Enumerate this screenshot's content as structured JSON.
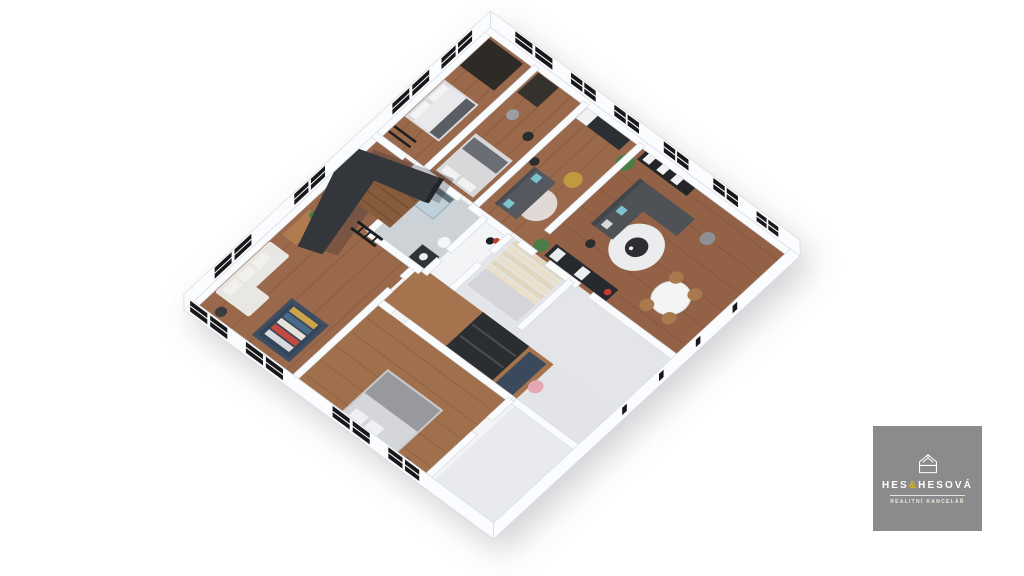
{
  "page": {
    "background_color": "#ffffff",
    "description": "3D isometric cutaway floor plan rendering of a furnished apartment storey"
  },
  "logo": {
    "brand_pre": "HES",
    "brand_amp": "&",
    "brand_post": "HESOVÁ",
    "tagline": "REALITNÍ KANCELÁŘ",
    "background_color": "#8a8b8d",
    "text_color": "#ffffff",
    "ampersand_color": "#d9b411",
    "icon": "house-outline-icon"
  },
  "floor_plan": {
    "projection": "isometric-cutaway",
    "wall_color": "#fbfcfd",
    "window_frame_color": "#17181a",
    "wood_floor_color": "#9a684a",
    "tile_floor_color": "#cdd2d7",
    "dark_accent_color": "#33373c",
    "window_count": 14,
    "door_openings_southeast": 4,
    "rooms": [
      {
        "name": "lounge-office-northwest",
        "furniture": [
          "white-corner-sofa",
          "wooden-desk",
          "desk-chair",
          "navy-open-wardrobe-with-clothes",
          "dark-side-table",
          "plant"
        ]
      },
      {
        "name": "loft-structure",
        "furniture": [
          "black-elevated-loft-volume",
          "wood-panel-wall",
          "black-ladder"
        ]
      },
      {
        "name": "bathroom-center",
        "furniture": [
          "glass-shower-cabin",
          "dark-vanity",
          "toilet"
        ]
      },
      {
        "name": "bedroom-north",
        "furniture": [
          "double-bed",
          "dark-wardrobe",
          "black-ladder"
        ]
      },
      {
        "name": "bedroom-middle",
        "furniture": [
          "double-bed",
          "floor-lamp",
          "dark-wardrobe",
          "grey-pouf"
        ]
      },
      {
        "name": "studio-kitchen-lounge",
        "furniture": [
          "grey-sofa-cyan-pillows",
          "kitchenette-counter",
          "fridge",
          "round-rug",
          "mustard-armchair",
          "floor-lamp"
        ]
      },
      {
        "name": "living-dining-southeast",
        "furniture": [
          "dark-corner-sofa",
          "round-coffee-table",
          "white-round-rug",
          "white-dining-table",
          "wooden-dining-chairs",
          "dark-kitchen-run",
          "media-shelf-unit",
          "potted-plant",
          "floor-lamp",
          "grey-pouf"
        ]
      },
      {
        "name": "hall-staircase",
        "furniture": [
          "wooden-staircase",
          "concrete-landing",
          "coat-rack-red-bag"
        ]
      },
      {
        "name": "bedroom-south",
        "furniture": [
          "double-bed-grey-bedding",
          "dark-wardrobe",
          "navy-desk",
          "pink-desk-chair",
          "side-table"
        ]
      },
      {
        "name": "balcony-south",
        "furniture": []
      }
    ]
  }
}
